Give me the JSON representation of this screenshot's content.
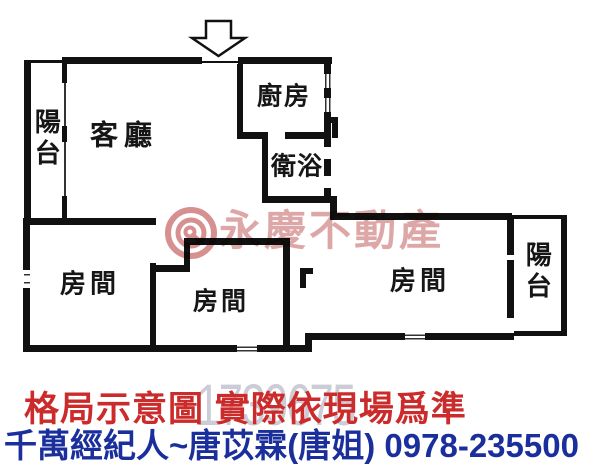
{
  "colors": {
    "wall": "#111111",
    "disclaimer_red": "#cc2b2b",
    "agent_blue": "#1b2f9c",
    "watermark_pink": "#d89898",
    "serial_gray": "#cbccd6"
  },
  "floor_plan": {
    "rooms": [
      {
        "id": "balcony-left",
        "label": "陽台"
      },
      {
        "id": "living-room",
        "label": "客廳"
      },
      {
        "id": "kitchen",
        "label": "廚房"
      },
      {
        "id": "bathroom",
        "label": "衛浴"
      },
      {
        "id": "bedroom-left",
        "label": "房間"
      },
      {
        "id": "bedroom-middle",
        "label": "房間"
      },
      {
        "id": "bedroom-right",
        "label": "房間"
      },
      {
        "id": "balcony-right",
        "label": "陽台"
      }
    ]
  },
  "watermark": {
    "brand": "永慶不動產",
    "serial": "1739675"
  },
  "footer": {
    "disclaimer": "格局示意圖 實際依現場爲準",
    "agent": "千萬經紀人~唐苡霖(唐姐) 0978-235500"
  }
}
